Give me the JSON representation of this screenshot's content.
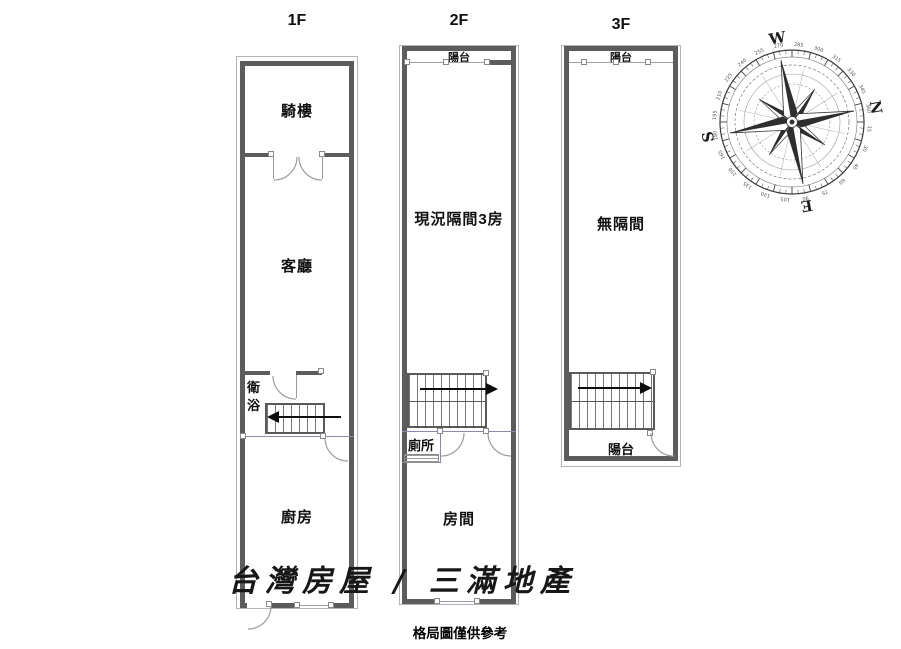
{
  "floors": [
    {
      "title": "1F",
      "rooms": {
        "arcade": "騎樓",
        "living": "客廳",
        "bath": "衛浴",
        "kitchen": "廚房"
      }
    },
    {
      "title": "2F",
      "rooms": {
        "balcony": "陽台",
        "main": "現況隔間3房",
        "toilet": "廁所",
        "room": "房間"
      }
    },
    {
      "title": "3F",
      "rooms": {
        "balcony_top": "陽台",
        "main": "無隔間",
        "balcony_bottom": "陽台"
      }
    }
  ],
  "watermark": "台灣房屋 / 三滿地產",
  "caption": "格局圖僅供參考",
  "compass": {
    "letters": {
      "n": "N",
      "e": "E",
      "s": "S",
      "w": "W"
    },
    "rotation_deg": 80,
    "tick_label_step": 15
  },
  "colors": {
    "wall": "#5c5c5c",
    "thin_line": "#9aa0a8",
    "accent_line": "#8a8aad",
    "text": "#111111"
  }
}
